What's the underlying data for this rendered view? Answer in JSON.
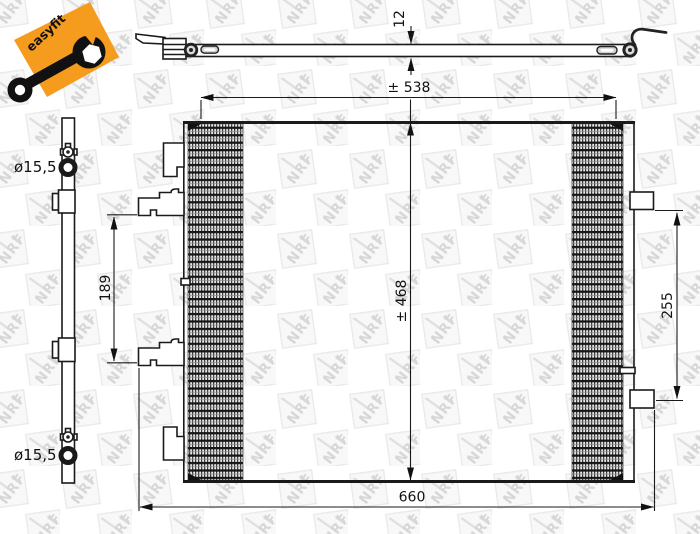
{
  "badge": {
    "label": "easyfit",
    "color": "#F59B1E"
  },
  "watermark": {
    "text": "NRF"
  },
  "dimensions": {
    "top_view_thickness": "12",
    "core_width": "± 538",
    "core_height": "± 468",
    "overall_width": "660",
    "left_mount_spacing": "189",
    "right_mount_spacing": "255",
    "top_port_diameter": "ø15,5",
    "bottom_port_diameter": "ø15,5"
  }
}
